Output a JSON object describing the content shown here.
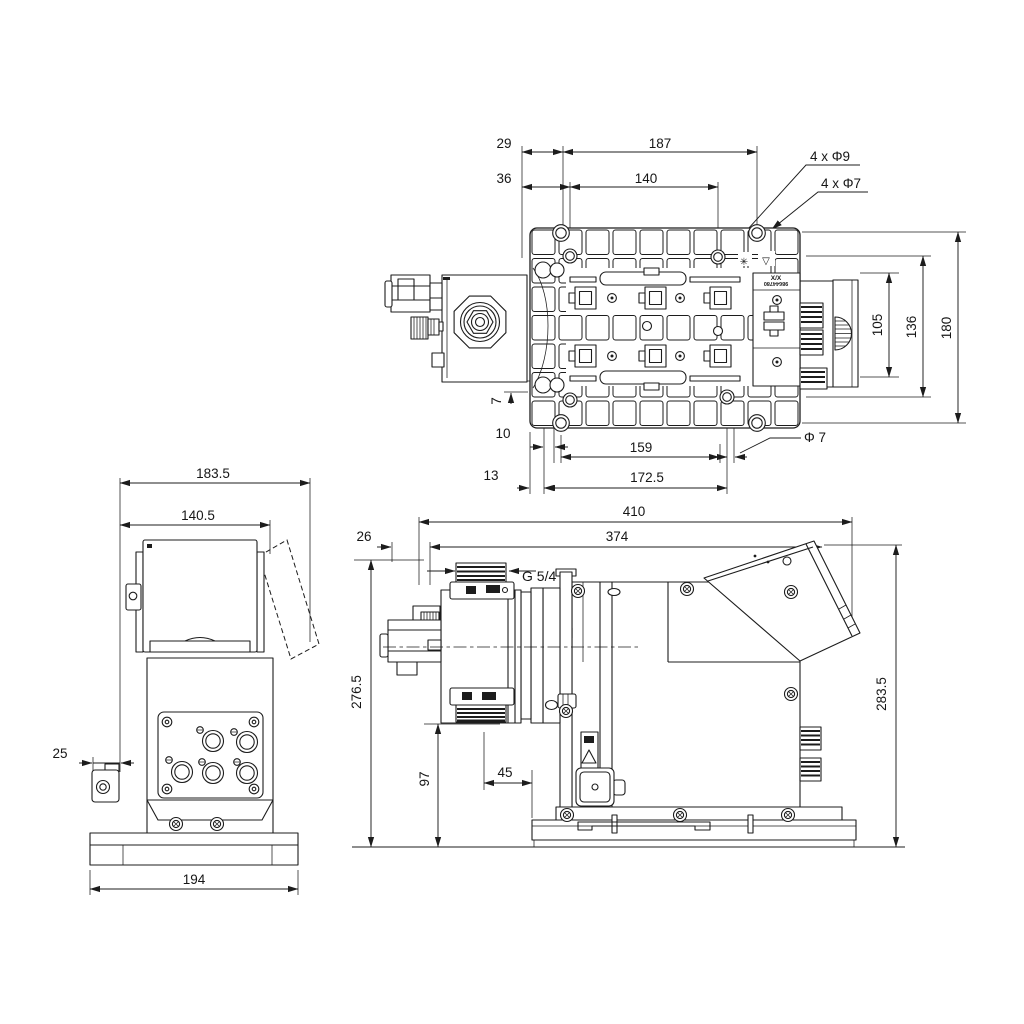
{
  "drawing": {
    "colors": {
      "ink": "#1c1c1c",
      "background": "#ffffff"
    },
    "views": {
      "top": {
        "dims": {
          "d29": "29",
          "d187": "187",
          "d36": "36",
          "d140": "140",
          "d105": "105",
          "d136": "136",
          "d180": "180",
          "d7": "7",
          "d10": "10",
          "d159": "159",
          "d13": "13",
          "d172_5": "172.5",
          "dia7": "Φ 7"
        },
        "callouts": {
          "holes9": "4 x Φ9",
          "holes7": "4 x Φ7"
        },
        "nameplate": {
          "code": "X/X",
          "serial": "98644780"
        },
        "symbols": {
          "flower": "✳",
          "triangle": "▽"
        }
      },
      "front": {
        "dims": {
          "d183_5": "183.5",
          "d140_5": "140.5",
          "d25": "25",
          "d194": "194"
        }
      },
      "side": {
        "dims": {
          "d410": "410",
          "d374": "374",
          "d26": "26",
          "d276_5": "276.5",
          "d97": "97",
          "d45": "45",
          "d283_5": "283.5"
        },
        "callouts": {
          "thread": "G 5/4''"
        }
      }
    }
  }
}
